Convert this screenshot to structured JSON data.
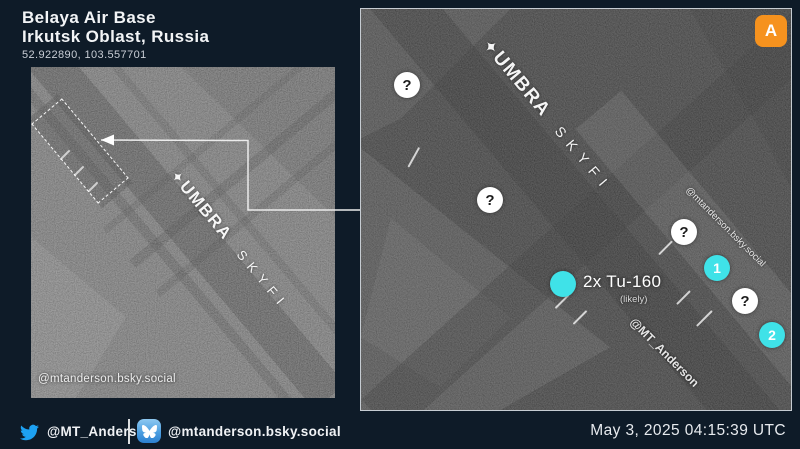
{
  "header": {
    "title": "Belaya Air Base",
    "subtitle": "Irkutsk Oblast, Russia",
    "coordinates": "52.922890, 103.557701"
  },
  "overview_panel": {
    "umbra_logo_glyph": "✦",
    "umbra_brand": "UMBRA",
    "umbra_product": "SKYFI",
    "watermark": "@mtanderson.bsky.social"
  },
  "detail_panel": {
    "badge": "A",
    "umbra_logo_glyph": "✦",
    "umbra_brand": "UMBRA",
    "umbra_product": "SKYFI",
    "watermark_bluesky": "@mtanderson.bsky.social",
    "watermark_twitter": "@MT_Anderson",
    "aircraft_label": "2x Tu-160",
    "aircraft_qualifier": "(likely)",
    "markers": [
      {
        "label": "?",
        "kind": "question"
      },
      {
        "label": "?",
        "kind": "question"
      },
      {
        "label": "?",
        "kind": "question"
      },
      {
        "label": "1",
        "kind": "numbered"
      },
      {
        "label": "?",
        "kind": "question"
      },
      {
        "label": "2",
        "kind": "numbered"
      }
    ]
  },
  "footer": {
    "twitter_handle": "@MT_Anderson",
    "bluesky_handle": "@mtanderson.bsky.social",
    "timestamp": "May 3, 2025 04:15:39 UTC"
  },
  "colors": {
    "background": "#0E1B28",
    "accent_cyan": "#3FE2E8",
    "badge_orange": "#F6921E",
    "twitter_blue": "#1DA1F2",
    "bluesky_blue": "#3D9AE8",
    "panel_border": "#C6CCD2"
  }
}
